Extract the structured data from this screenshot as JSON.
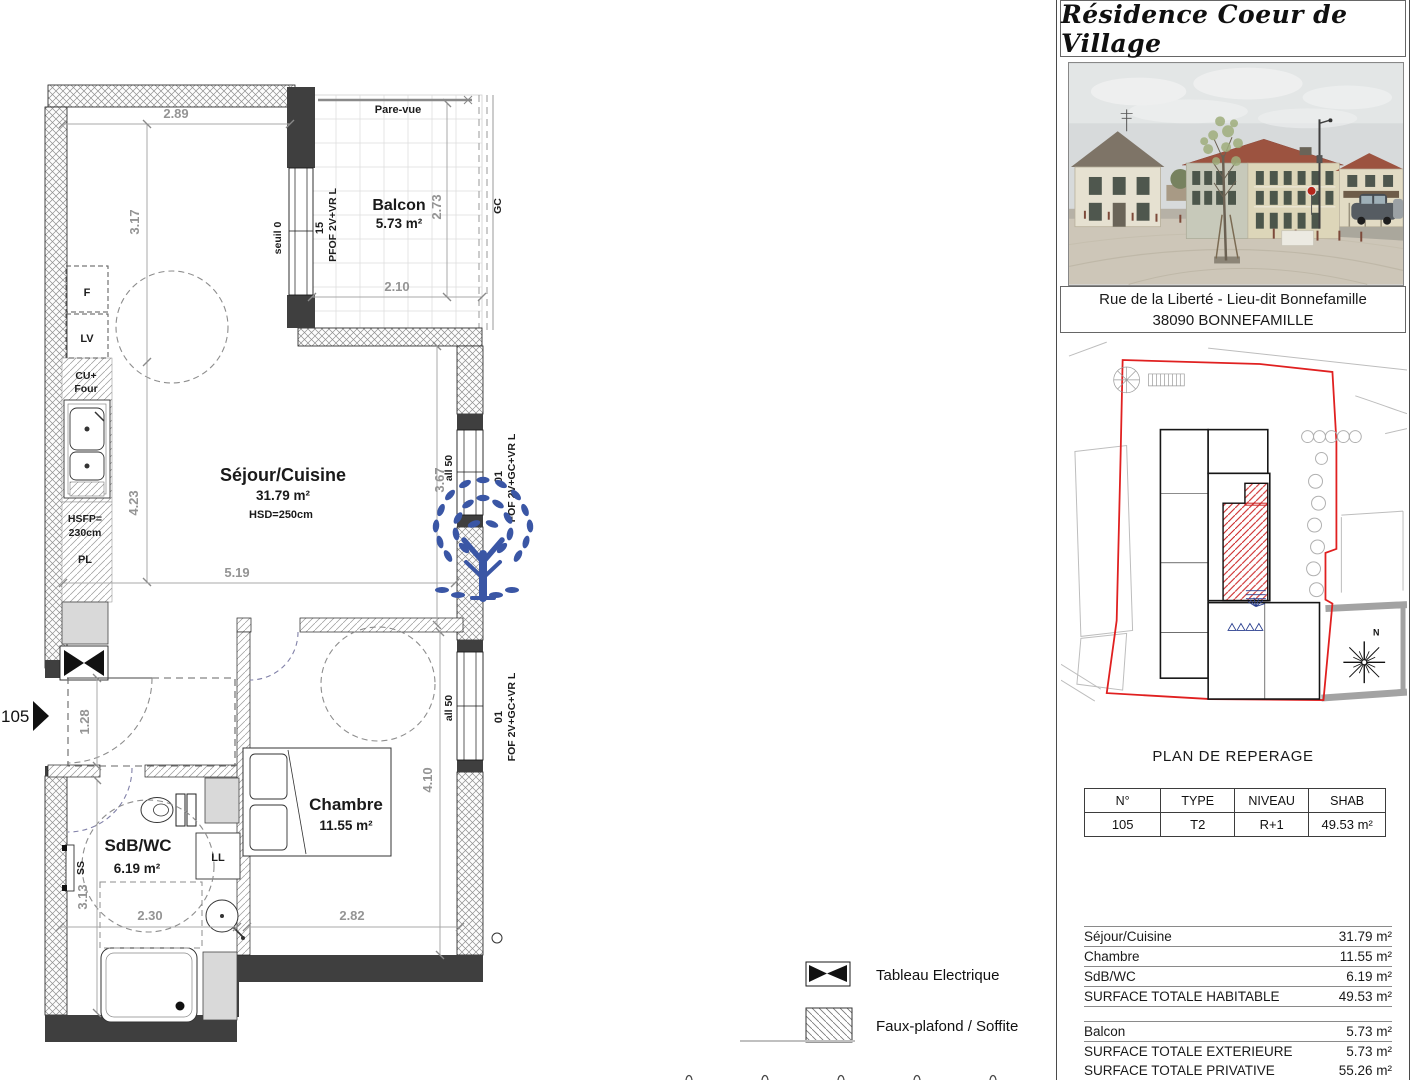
{
  "colors": {
    "wall_dark": "#3f3f3f",
    "dimension_gray": "#949494",
    "logo_blue": "#3a56a5",
    "site_boundary_red": "#e02020",
    "unit_hatch_red": "#cc2626",
    "roof_red": "#9c5340"
  },
  "plan": {
    "unit": "105",
    "rooms": {
      "balcon": {
        "name": "Balcon",
        "area": "5.73 m²"
      },
      "sejour": {
        "name": "Séjour/Cuisine",
        "area": "31.79 m²",
        "note": "HSD=250cm"
      },
      "chambre": {
        "name": "Chambre",
        "area": "11.55 m²"
      },
      "sdb": {
        "name": "SdB/WC",
        "area": "6.19 m²"
      }
    },
    "dims": {
      "w289": "2.89",
      "h317": "3.17",
      "h423": "4.23",
      "w519": "5.19",
      "h367": "3.67",
      "h273": "2.73",
      "w210": "2.10",
      "h128": "1.28",
      "h313": "3.13",
      "w230": "2.30",
      "w282": "2.82",
      "h410": "4.10"
    },
    "ann": {
      "parevue": "Pare-vue",
      "gc": "GC",
      "seuil": "seuil 0",
      "num15": "15",
      "pfof": "PFOF 2V+VR L",
      "all50": "all 50",
      "num01": "01",
      "fof": "FOF 2V+GC+VR L",
      "f": "F",
      "lv": "LV",
      "cu": "CU+",
      "four": "Four",
      "hsfp": "HSFP=",
      "cm230": "230cm",
      "pl": "PL",
      "ss": "SS",
      "ll": "LL"
    }
  },
  "legend": {
    "electric": "Tableau Electrique",
    "soffit": "Faux-plafond / Soffite"
  },
  "panel": {
    "title": "Résidence Coeur de Village",
    "address1": "Rue de la Liberté - Lieu-dit Bonnefamille",
    "address2": "38090 BONNEFAMILLE",
    "plan_title": "PLAN DE REPERAGE",
    "north": "N",
    "table": {
      "h_num": "N°",
      "h_type": "TYPE",
      "h_niveau": "NIVEAU",
      "h_shab": "SHAB",
      "num": "105",
      "type": "T2",
      "niveau": "R+1",
      "shab": "49.53 m²"
    },
    "surf1": [
      [
        "Séjour/Cuisine",
        "31.79 m²"
      ],
      [
        "Chambre",
        "11.55 m²"
      ],
      [
        "SdB/WC",
        "6.19 m²"
      ],
      [
        "SURFACE TOTALE HABITABLE",
        "49.53 m²"
      ]
    ],
    "surf2": [
      [
        "Balcon",
        "5.73 m²"
      ],
      [
        "SURFACE TOTALE EXTERIEURE",
        "5.73 m²"
      ],
      [
        "SURFACE TOTALE PRIVATIVE",
        "55.26 m²"
      ]
    ]
  }
}
